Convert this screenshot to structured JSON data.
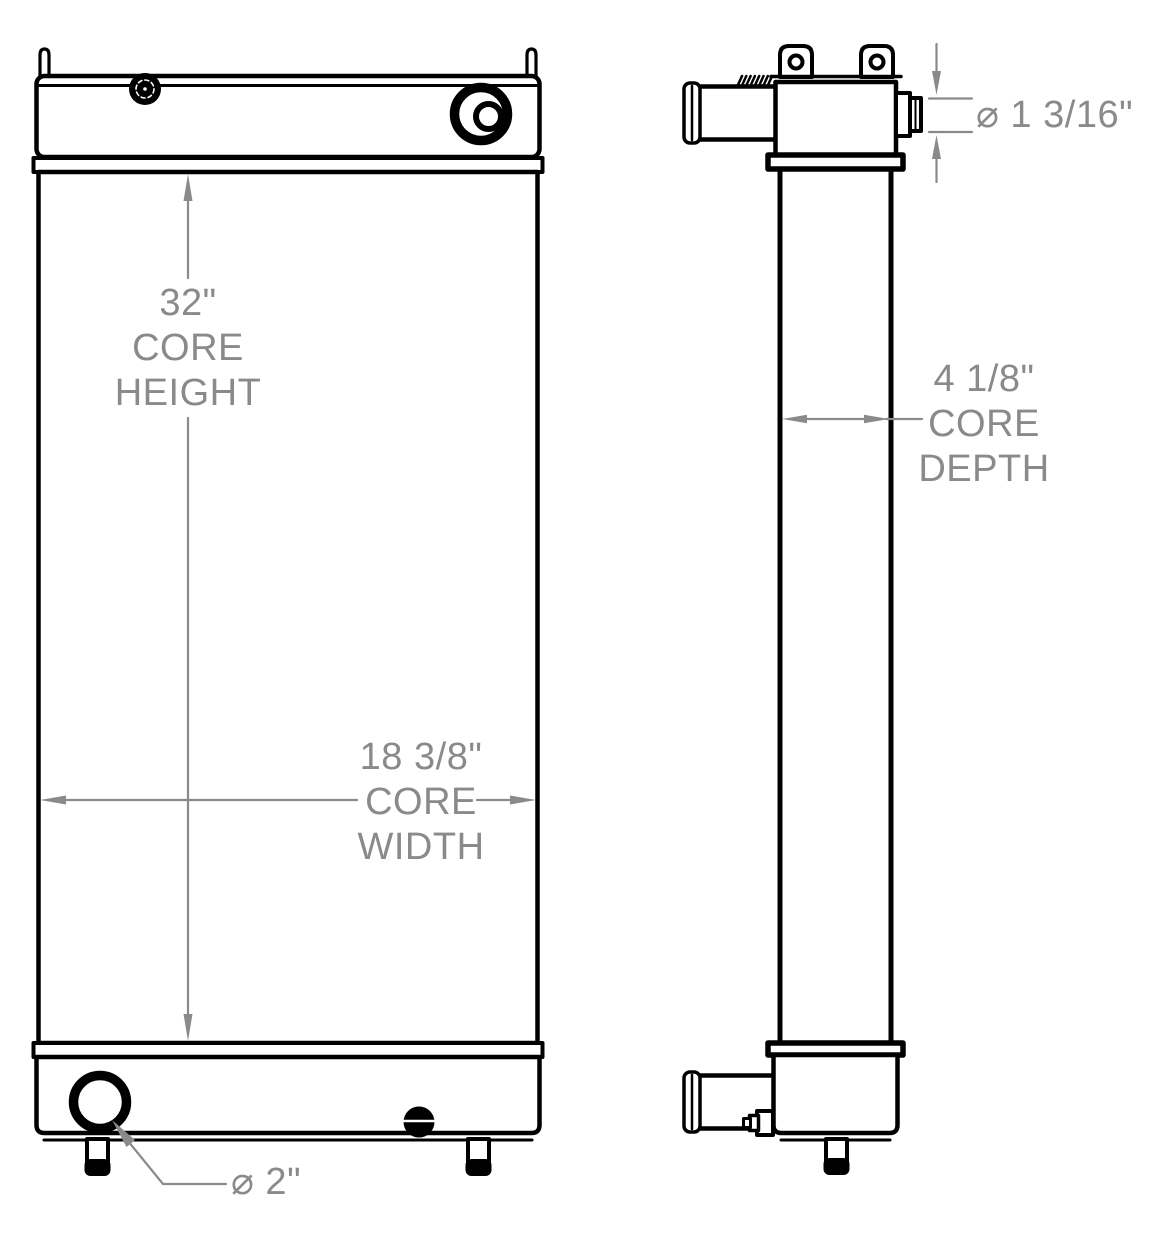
{
  "meta": {
    "title": "Radiator technical drawing",
    "description": "Two orthographic views of a radiator with core dimensions"
  },
  "colors": {
    "background": "#ffffff",
    "outline": "#000000",
    "dimension": "#8a8a8a"
  },
  "views": {
    "front": {
      "name": "Front view"
    },
    "side": {
      "name": "Side view"
    }
  },
  "dimensions": {
    "core_height": {
      "value": "32\"",
      "line2": "CORE",
      "line3": "HEIGHT"
    },
    "core_width": {
      "value": "18 3/8\"",
      "line2": "CORE",
      "line3": "WIDTH"
    },
    "core_depth": {
      "value": "4 1/8\"",
      "line2": "CORE",
      "line3": "DEPTH"
    },
    "top_port_diameter": {
      "value": "⌀ 1 3/16\""
    },
    "bottom_port_diameter": {
      "value": "⌀ 2\""
    }
  }
}
